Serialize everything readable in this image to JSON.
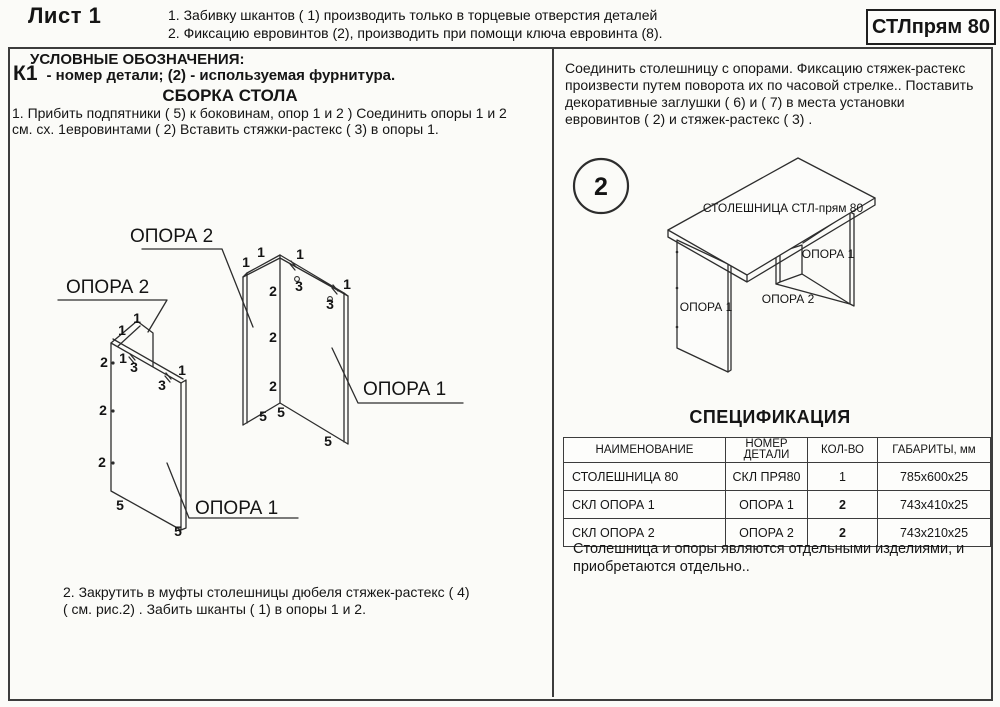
{
  "header": {
    "sheet": "Лист 1",
    "notes": "1. Забивку шкантов  ( 1)   производить только в торцевые отверстия деталей\n2. Фиксацию евровинтов (2),  производить при помощи ключа евровинта (8).",
    "code": "СТЛпрям 80"
  },
  "left": {
    "legend_title": "УСЛОВНЫЕ ОБОЗНАЧЕНИЯ:",
    "legend_symbol": "К1",
    "legend_desc": "- номер детали;  (2) - используемая фурнитура.",
    "section_title": "СБОРКА СТОЛА",
    "step1": "1. Прибить подпятники  ( 5)   к боковинам, опор 1 и 2 )  Соединить опоры  1 и 2\nсм. сх. 1евровинтами  ( 2)  Вставить стяжки-растекс  ( 3)   в опоры 1.",
    "step2": "2. Закрутить в муфты столешницы дюбеля стяжек-растекс  ( 4)\n( см. рис.2)  . Забить шканты  ( 1)   в опоры 1 и 2."
  },
  "left_diagram": {
    "texts": [
      {
        "t": "ОПОРА 2",
        "x": 80,
        "y": 30,
        "c": "L"
      },
      {
        "t": "ОПОРА 2",
        "x": 16,
        "y": 81,
        "c": "L"
      },
      {
        "t": "ОПОРА 1",
        "x": 313,
        "y": 183,
        "c": "L"
      },
      {
        "t": "ОПОРА 1",
        "x": 145,
        "y": 302,
        "c": "L"
      },
      {
        "t": "1",
        "x": 72,
        "y": 123,
        "c": "n"
      },
      {
        "t": "1",
        "x": 87,
        "y": 111,
        "c": "n"
      },
      {
        "t": "2",
        "x": 54,
        "y": 155,
        "c": "n"
      },
      {
        "t": "2",
        "x": 53,
        "y": 203,
        "c": "n"
      },
      {
        "t": "2",
        "x": 52,
        "y": 255,
        "c": "n"
      },
      {
        "t": "1",
        "x": 73,
        "y": 151,
        "c": "n"
      },
      {
        "t": "3",
        "x": 84,
        "y": 160,
        "c": "n"
      },
      {
        "t": "3",
        "x": 112,
        "y": 178,
        "c": "n"
      },
      {
        "t": "1",
        "x": 132,
        "y": 163,
        "c": "n"
      },
      {
        "t": "5",
        "x": 70,
        "y": 298,
        "c": "n"
      },
      {
        "t": "5",
        "x": 128,
        "y": 324,
        "c": "n"
      },
      {
        "t": "1",
        "x": 196,
        "y": 55,
        "c": "n"
      },
      {
        "t": "1",
        "x": 211,
        "y": 45,
        "c": "n"
      },
      {
        "t": "1",
        "x": 250,
        "y": 47,
        "c": "n"
      },
      {
        "t": "1",
        "x": 297,
        "y": 77,
        "c": "n"
      },
      {
        "t": "3",
        "x": 249,
        "y": 79,
        "c": "n"
      },
      {
        "t": "3",
        "x": 280,
        "y": 97,
        "c": "n"
      },
      {
        "t": "2",
        "x": 223,
        "y": 84,
        "c": "n"
      },
      {
        "t": "2",
        "x": 223,
        "y": 130,
        "c": "n"
      },
      {
        "t": "2",
        "x": 223,
        "y": 179,
        "c": "n"
      },
      {
        "t": "5",
        "x": 213,
        "y": 209,
        "c": "n"
      },
      {
        "t": "5",
        "x": 231,
        "y": 205,
        "c": "n"
      },
      {
        "t": "5",
        "x": 278,
        "y": 234,
        "c": "n"
      }
    ]
  },
  "right": {
    "instruction": "Соединить столешницу с опорами. Фиксацию стяжек-растекс\nпроизвести путем поворота их по часовой стрелке.. Поставить\nдекоративные заглушки  ( 6)   и  ( 7)   в места установки\nевровинтов  ( 2)   и стяжек-растекс  ( 3)  .",
    "spec_title": "СПЕЦИФИКАЦИЯ",
    "spec_columns": [
      "НАИМЕНОВАНИЕ",
      "НОМЕР\nДЕТАЛИ",
      "КОЛ-ВО",
      "ГАБАРИТЫ, мм"
    ],
    "spec_rows": [
      [
        "СТОЛЕШНИЦА 80",
        "СКЛ ПРЯ80",
        "1",
        "785x600x25"
      ],
      [
        "СКЛ ОПОРА 1",
        "ОПОРА 1",
        "2",
        "743x410x25"
      ],
      [
        "СКЛ ОПОРА 2",
        "ОПОРА 2",
        "2",
        "743x210x25"
      ]
    ],
    "footnote": "Столешница и опоры являются отдельными изделиями, и\nприобретаются отдельно.."
  },
  "right_diagram": {
    "texts": [
      {
        "t": "2",
        "x": 41,
        "y": 45,
        "c": "f"
      },
      {
        "t": "СТОЛЕШНИЦА СТЛ-прям 80",
        "x": 223,
        "y": 62,
        "c": "d"
      },
      {
        "t": "ОПОРА 1",
        "x": 268,
        "y": 108,
        "c": "d"
      },
      {
        "t": "ОПОРА 2",
        "x": 228,
        "y": 153,
        "c": "d"
      },
      {
        "t": "ОПОРА 1",
        "x": 146,
        "y": 161,
        "c": "d"
      }
    ]
  }
}
